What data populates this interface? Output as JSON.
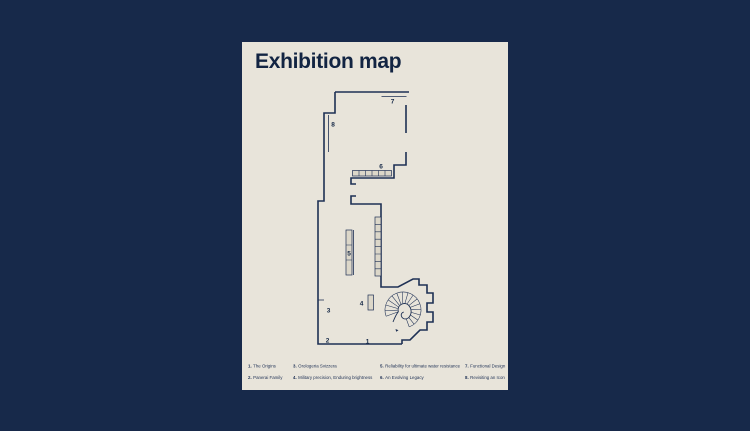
{
  "poster": {
    "title": "Exhibition map",
    "colors": {
      "page_background": "#17294a",
      "poster_background": "#e8e4da",
      "ink": "#1e3054"
    }
  },
  "map": {
    "markers": [
      "1",
      "2",
      "3",
      "4",
      "5",
      "6",
      "7",
      "8"
    ]
  },
  "legend": {
    "items": [
      {
        "num": "1.",
        "label": "The Origins"
      },
      {
        "num": "2.",
        "label": "Panerai Family"
      },
      {
        "num": "3.",
        "label": "Orologeria Svizzera"
      },
      {
        "num": "4.",
        "label": "Military precision, Enduring brightness"
      },
      {
        "num": "5.",
        "label": "Reliability for ultimate water resistance"
      },
      {
        "num": "6.",
        "label": "An Evolving Legacy"
      },
      {
        "num": "7.",
        "label": "Functional Design"
      },
      {
        "num": "8.",
        "label": "Revisiting an Icon"
      }
    ]
  }
}
